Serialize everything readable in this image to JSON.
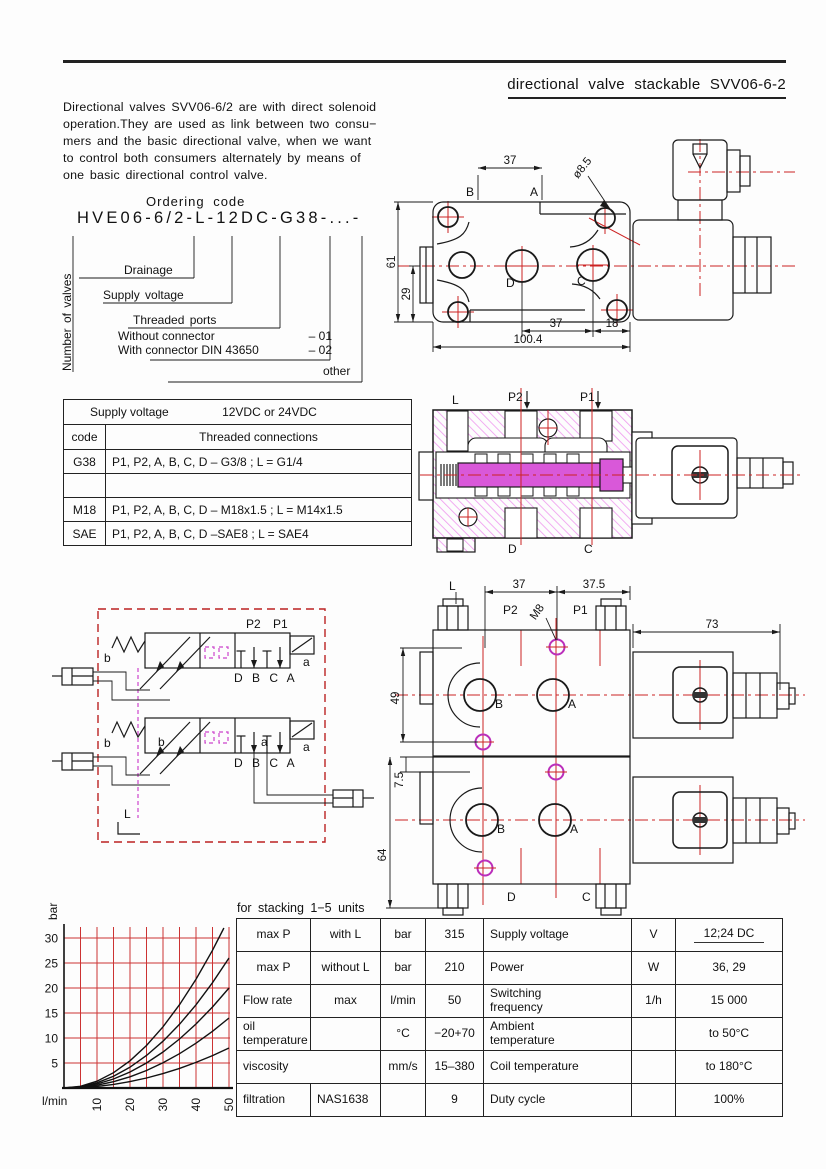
{
  "colors": {
    "ink": "#1a1a1a",
    "accent_red": "#cc2222",
    "magenta": "#bb2fbb",
    "hatch_pink": "#ef9eef",
    "schematic_border": "#bb2222"
  },
  "header": {
    "title": "directional  valve  stackable SVV06-6-2"
  },
  "intro": {
    "lines": [
      "Directional  valves SVV06-6/2  are  with  direct  solenoid",
      "operation.They  are  used  as  link  between  two  consu−",
      "mers  and  the  basic  directional  valve,  when  we  want",
      "to  control  both  consumers  alternately  by  means  of",
      "one  basic  directional  control  valve."
    ]
  },
  "ordering": {
    "title": "Ordering  code",
    "code": "HVE06-6/2-L-12DC-G38-...-",
    "vertical_label": "Number of valves",
    "drainage": "Drainage",
    "supply_voltage": "Supply voltage",
    "threaded_ports": "Threaded ports",
    "without_connector": "Without connector",
    "without_code": "– 01",
    "with_connector": "With connector DIN 43650",
    "with_code": "– 02",
    "other": "other"
  },
  "threads_table": {
    "supply_label": "Supply voltage",
    "supply_value": "12VDC or 24VDC",
    "col_code": "code",
    "col_conn": "Threaded connections",
    "rows": [
      {
        "code": "G38",
        "conn": "P1, P2, A, B, C, D – G3/8 ; L = G1/4"
      },
      {
        "code": "",
        "conn": ""
      },
      {
        "code": "M18",
        "conn": "P1, P2, A, B, C, D – M18x1.5 ; L = M14x1.5"
      },
      {
        "code": "SAE",
        "conn": "P1, P2, A, B, C, D –SAE8 ; L = SAE4"
      }
    ]
  },
  "drawing_top": {
    "dim_width_ba": "37",
    "label_b": "B",
    "label_a": "A",
    "hole_dia": "ø8.5",
    "dim_height": "61",
    "dim_29": "29",
    "port_d": "D",
    "port_c": "C",
    "dim_dc": "37",
    "dim_18": "18",
    "dim_total": "100.4"
  },
  "drawing_section": {
    "port_l": "L",
    "port_p2": "P2",
    "port_p1": "P1",
    "port_d": "D",
    "port_c": "C"
  },
  "schematic": {
    "port_p2": "P2",
    "port_p1": "P1",
    "ports_bottom": "D B C A",
    "spring_label": "b",
    "solenoid_label": "a",
    "drain_label": "L"
  },
  "drawing_stack": {
    "port_l": "L",
    "dim_37": "37",
    "dim_37_5": "37.5",
    "thread_m8": "M8",
    "port_p2": "P2",
    "port_p1": "P1",
    "dim_73": "73",
    "dim_49": "49",
    "dim_7_5": "7.5",
    "dim_64": "64",
    "port_b": "B",
    "port_a": "A",
    "port_d": "D",
    "port_c": "C"
  },
  "chart_data": {
    "type": "line",
    "title": "pressure drop vs flow",
    "xlabel": "l/min",
    "ylabel": "bar",
    "xlim": [
      0,
      50
    ],
    "ylim": [
      0,
      32
    ],
    "xticks": [
      10,
      20,
      30,
      40,
      50
    ],
    "yticks": [
      5,
      10,
      15,
      20,
      25,
      30
    ],
    "grid_step": 5,
    "grid_color": "#cc3333",
    "series": [
      {
        "name": "curve-1",
        "points": [
          [
            0,
            0
          ],
          [
            5,
            0.08
          ],
          [
            10,
            0.32
          ],
          [
            15,
            0.72
          ],
          [
            20,
            1.28
          ],
          [
            25,
            2.0
          ],
          [
            30,
            2.88
          ],
          [
            35,
            3.92
          ],
          [
            40,
            5.12
          ],
          [
            45,
            6.48
          ],
          [
            50,
            8.0
          ]
        ]
      },
      {
        "name": "curve-2",
        "points": [
          [
            0,
            0
          ],
          [
            5,
            0.14
          ],
          [
            10,
            0.56
          ],
          [
            15,
            1.26
          ],
          [
            20,
            2.24
          ],
          [
            25,
            3.5
          ],
          [
            30,
            5.04
          ],
          [
            35,
            6.86
          ],
          [
            40,
            8.96
          ],
          [
            45,
            11.34
          ],
          [
            50,
            14.0
          ]
        ]
      },
      {
        "name": "curve-3",
        "points": [
          [
            0,
            0
          ],
          [
            5,
            0.2
          ],
          [
            10,
            0.8
          ],
          [
            15,
            1.8
          ],
          [
            20,
            3.2
          ],
          [
            25,
            5.0
          ],
          [
            30,
            7.2
          ],
          [
            35,
            9.8
          ],
          [
            40,
            12.8
          ],
          [
            45,
            16.2
          ],
          [
            50,
            20.0
          ]
        ]
      },
      {
        "name": "curve-4",
        "points": [
          [
            0,
            0
          ],
          [
            5,
            0.26
          ],
          [
            10,
            1.04
          ],
          [
            15,
            2.34
          ],
          [
            20,
            4.16
          ],
          [
            25,
            6.5
          ],
          [
            30,
            9.36
          ],
          [
            35,
            12.74
          ],
          [
            40,
            16.64
          ],
          [
            45,
            21.06
          ],
          [
            50,
            26.0
          ]
        ]
      },
      {
        "name": "curve-5",
        "points": [
          [
            0,
            0
          ],
          [
            5,
            0.34
          ],
          [
            10,
            1.36
          ],
          [
            15,
            3.06
          ],
          [
            20,
            5.44
          ],
          [
            25,
            8.5
          ],
          [
            30,
            12.24
          ],
          [
            35,
            16.66
          ],
          [
            40,
            21.76
          ],
          [
            45,
            27.54
          ],
          [
            50,
            34.0
          ]
        ]
      }
    ]
  },
  "specs_table": {
    "title": "for  stacking  1−5  units",
    "rows": [
      {
        "c1": "max P",
        "c2": "with L",
        "c3": "bar",
        "c4": "315",
        "c5": "Supply voltage",
        "c6": "V",
        "c7": "12;24 DC"
      },
      {
        "c1": "max P",
        "c2": "without L",
        "c3": "bar",
        "c4": "210",
        "c5": "Power",
        "c6": "W",
        "c7": "36, 29"
      },
      {
        "c1": "Flow rate",
        "c2": "max",
        "c3": "l/min",
        "c4": "50",
        "c5": "Switching\nfrequency",
        "c6": "1/h",
        "c7": "15 000"
      },
      {
        "c1": "oil\ntemperature",
        "c2": "",
        "c3": "°C",
        "c4": "−20+70",
        "c5": "Ambient\ntemperature",
        "c6": "",
        "c7": "to 50°C"
      },
      {
        "c1": "viscosity",
        "c2": "",
        "c3": "mm/s",
        "c4": "15–380",
        "c5": "Coil temperature",
        "c6": "",
        "c7": "to 180°C"
      },
      {
        "c1": "filtration",
        "c2": "NAS1638",
        "c3": "",
        "c4": "9",
        "c5": "Duty cycle",
        "c6": "",
        "c7": "100%"
      }
    ]
  }
}
